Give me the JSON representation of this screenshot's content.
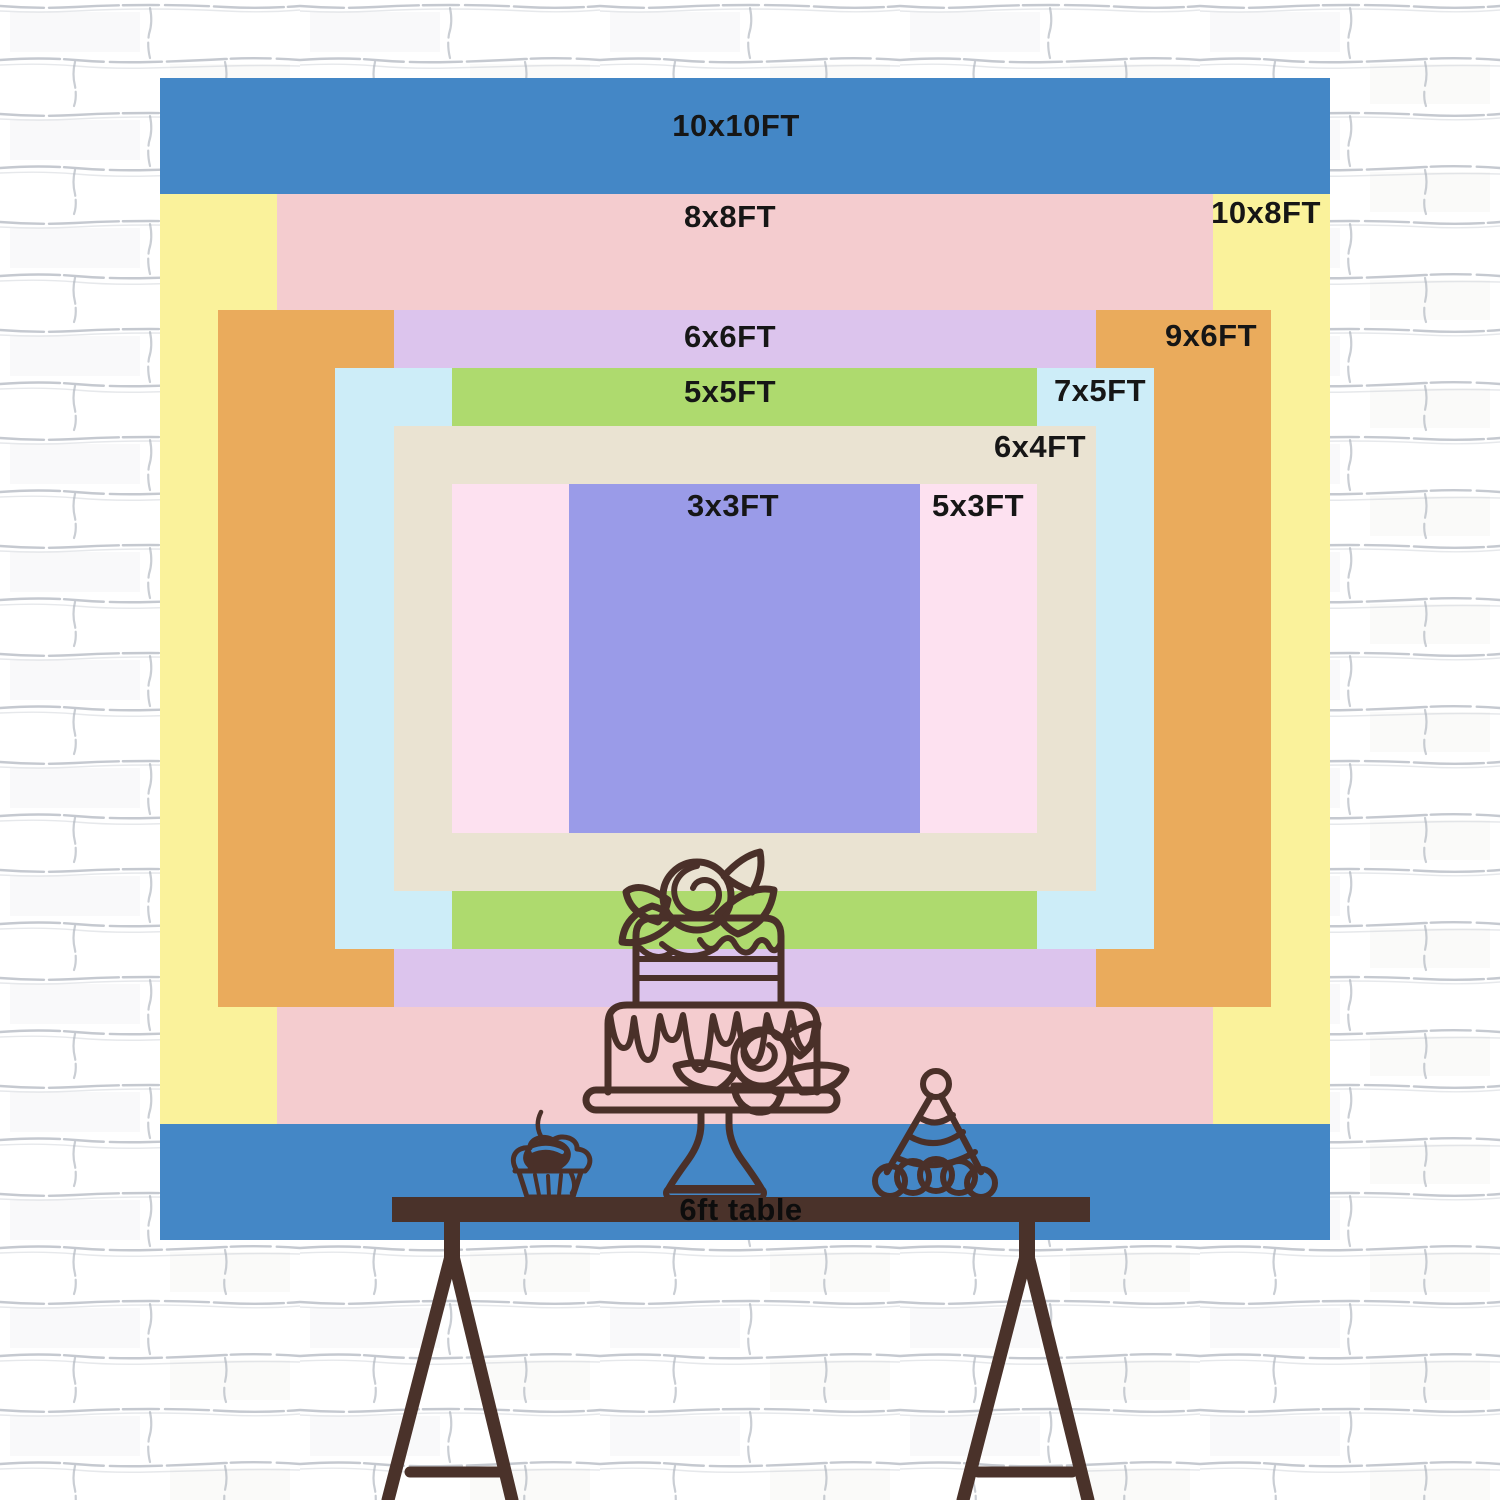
{
  "scene": {
    "type": "backdrop-size-comparison-chart",
    "wall": {
      "brick_fill": "#ffffff",
      "mortar_color": "#a6adb7"
    }
  },
  "backdrop": {
    "unit": "FT",
    "sizes": [
      {
        "id": "10x10",
        "label": "10x10FT",
        "width_ft": 10,
        "height_ft": 10,
        "color": "#4487c6"
      },
      {
        "id": "10x8",
        "label": "10x8FT",
        "width_ft": 10,
        "height_ft": 8,
        "color": "#faf29b"
      },
      {
        "id": "8x8",
        "label": "8x8FT",
        "width_ft": 8,
        "height_ft": 8,
        "color": "#f4cccf"
      },
      {
        "id": "9x6",
        "label": "9x6FT",
        "width_ft": 9,
        "height_ft": 6,
        "color": "#eaab5c"
      },
      {
        "id": "6x6",
        "label": "6x6FT",
        "width_ft": 6,
        "height_ft": 6,
        "color": "#dcc4ed"
      },
      {
        "id": "7x5",
        "label": "7x5FT",
        "width_ft": 7,
        "height_ft": 5,
        "color": "#cdedf8"
      },
      {
        "id": "5x5",
        "label": "5x5FT",
        "width_ft": 5,
        "height_ft": 5,
        "color": "#aeda6e"
      },
      {
        "id": "6x4",
        "label": "6x4FT",
        "width_ft": 6,
        "height_ft": 4,
        "color": "#eae3d2"
      },
      {
        "id": "5x3",
        "label": "5x3FT",
        "width_ft": 5,
        "height_ft": 3,
        "color": "#fde1f0"
      },
      {
        "id": "3x3",
        "label": "3x3FT",
        "width_ft": 3,
        "height_ft": 3,
        "color": "#9a9be8"
      }
    ]
  },
  "table": {
    "label": "6ft table",
    "color": "#4a322a"
  },
  "illustration": {
    "line_color": "#4a3029",
    "items": [
      "cupcake-with-cherry",
      "two-tier-cake-on-stand",
      "party-hat"
    ]
  }
}
